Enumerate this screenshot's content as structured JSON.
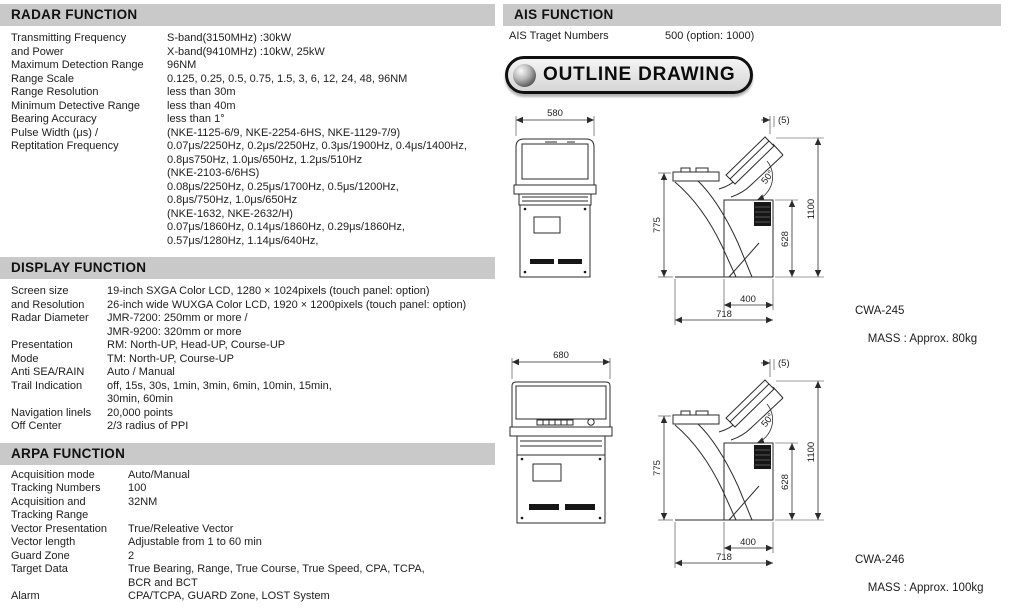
{
  "sections": {
    "radar": {
      "title": "RADAR FUNCTION",
      "rows": [
        {
          "label": "Transmitting Frequency",
          "value": "S-band(3150MHz) :30kW"
        },
        {
          "label": "and Power",
          "value": "X-band(9410MHz) :10kW, 25kW"
        },
        {
          "label": "Maximum Detection Range",
          "value": "96NM"
        },
        {
          "label": "Range Scale",
          "value": "0.125, 0.25, 0.5, 0.75, 1.5, 3, 6, 12, 24, 48, 96NM"
        },
        {
          "label": "Range Resolution",
          "value": "less than 30m"
        },
        {
          "label": "Minimum Detective Range",
          "value": "less than 40m"
        },
        {
          "label": "Bearing Accuracy",
          "value": "less than 1°"
        },
        {
          "label": "Pulse Width (μs) /",
          "value": "(NKE-1125-6/9, NKE-2254-6HS, NKE-1129-7/9)"
        },
        {
          "label": "Reptitation Frequency",
          "value": "0.07μs/2250Hz, 0.2μs/2250Hz, 0.3μs/1900Hz, 0.4μs/1400Hz,"
        },
        {
          "label": "",
          "value": "0.8μs750Hz, 1.0μs/650Hz, 1.2μs/510Hz"
        },
        {
          "label": "",
          "value": "(NKE-2103-6/6HS)"
        },
        {
          "label": "",
          "value": "0.08μs/2250Hz, 0.25μs/1700Hz, 0.5μs/1200Hz,"
        },
        {
          "label": "",
          "value": "0.8μs/750Hz, 1.0μs/650Hz"
        },
        {
          "label": "",
          "value": "(NKE-1632, NKE-2632/H)"
        },
        {
          "label": "",
          "value": "0.07μs/1860Hz, 0.14μs/1860Hz, 0.29μs/1860Hz,"
        },
        {
          "label": "",
          "value": "0.57μs/1280Hz, 1.14μs/640Hz,"
        }
      ]
    },
    "display": {
      "title": "DISPLAY FUNCTION",
      "rows": [
        {
          "label": "Screen size",
          "value": "19-inch SXGA Color LCD, 1280 × 1024pixels (touch panel: option)"
        },
        {
          "label": "and Resolution",
          "value": "26-inch wide WUXGA Color LCD, 1920 × 1200pixels (touch panel: option)"
        },
        {
          "label": "Radar Diameter",
          "value": "JMR-7200: 250mm or more /"
        },
        {
          "label": "",
          "value": "JMR-9200: 320mm or more"
        },
        {
          "label": "Presentation",
          "value": "RM: North-UP, Head-UP, Course-UP"
        },
        {
          "label": "Mode",
          "value": "TM: North-UP, Course-UP"
        },
        {
          "label": "Anti SEA/RAIN",
          "value": "Auto / Manual"
        },
        {
          "label": "Trail Indication",
          "value": "off, 15s, 30s, 1min, 3min, 6min, 10min, 15min,"
        },
        {
          "label": "",
          "value": "30min, 60min"
        },
        {
          "label": "Navigation linels",
          "value": "20,000 points"
        },
        {
          "label": "Off Center",
          "value": "2/3 radius of PPI"
        }
      ]
    },
    "arpa": {
      "title": "ARPA FUNCTION",
      "rows": [
        {
          "label": "Acquisition mode",
          "value": "Auto/Manual"
        },
        {
          "label": "Tracking Numbers",
          "value": "100"
        },
        {
          "label": "Acquisition and",
          "value": "32NM"
        },
        {
          "label": "Tracking Range",
          "value": ""
        },
        {
          "label": "Vector Presentation",
          "value": "True/Releative Vector"
        },
        {
          "label": "Vector length",
          "value": "Adjustable from 1 to 60 min"
        },
        {
          "label": "Guard Zone",
          "value": "2"
        },
        {
          "label": "Target Data",
          "value": "True Bearing, Range, True Course, True Speed, CPA, TCPA,"
        },
        {
          "label": "",
          "value": "BCR and BCT"
        },
        {
          "label": "Alarm",
          "value": "CPA/TCPA, GUARD Zone, LOST System"
        }
      ]
    },
    "ais": {
      "title": "AIS FUNCTION",
      "rows": [
        {
          "label": "AIS Traget Numbers",
          "value": "500 (option: 1000)"
        }
      ]
    }
  },
  "outline": {
    "badge_label": "OUTLINE DRAWING",
    "drawings": [
      {
        "model": "CWA-245",
        "mass": "MASS : Approx. 80kg",
        "dims": {
          "front_width": "580",
          "deck_height": "775",
          "overall_height": "1100",
          "cabinet_height": "628",
          "cabinet_depth": "400",
          "overall_depth": "718",
          "top_clearance": "(5)",
          "monitor_tilt": "50°"
        }
      },
      {
        "model": "CWA-246",
        "mass": "MASS : Approx. 100kg",
        "dims": {
          "front_width": "680",
          "deck_height": "775",
          "overall_height": "1100",
          "cabinet_height": "628",
          "cabinet_depth": "400",
          "overall_depth": "718",
          "top_clearance": "(5)",
          "monitor_tilt": "50°"
        }
      }
    ]
  },
  "colors": {
    "section_header_bg": "#c9c9c9",
    "text": "#1d1d1d",
    "drawing_line": "#2b2b2b"
  }
}
